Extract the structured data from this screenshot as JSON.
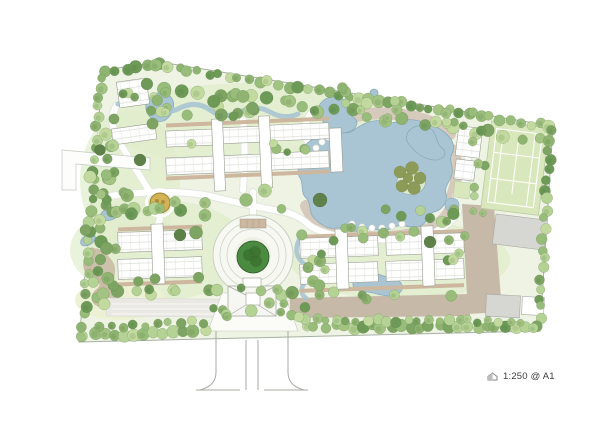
{
  "meta": {
    "scale_note": "1:250 @ A1"
  },
  "colors": {
    "paper": "#ffffff",
    "site_fill": "#eef3e3",
    "site_stroke": "#a7b0a2",
    "grass_dark": "#e0edcb",
    "grass_yellow": "#ecf1d4",
    "tan_blob": "#c9bba6",
    "water": "#a9c4d3",
    "water_stroke": "#8aabbe",
    "deck": "#d5cabb",
    "path_casing": "#e3e6dd",
    "path_white": "#ffffff",
    "road_brown": "#c6b9a8",
    "road_gray": "#e9e8e3",
    "court_green": "#d9e7bd",
    "court_line": "#ffffff",
    "building_fill": "#ffffff",
    "building_stroke": "#979c90",
    "unit_line": "#c6cabf",
    "shadow_tan": "#cdb79e",
    "gray_building": "#d6d6d2",
    "gray_building_stroke": "#a9a9a5",
    "plaza_fill": "#f7f8f2",
    "plaza_ring": "#c9cfc2",
    "center_tree": "#4b8a41",
    "center_tree_dark": "#39702f",
    "feature_gold": "#d2b254",
    "feature_ring": "#9b8336",
    "gate_stroke": "#a7aba3",
    "tree_stroke": "#5d7f49",
    "olive": "#8d9b58",
    "olive_stroke": "#6e7b3f",
    "dark_tree": "#5e8049",
    "tree_palette": [
      "#a3c383",
      "#8fb471",
      "#b4d294",
      "#7da463",
      "#c3da9f",
      "#98bd7a",
      "#6d9a57"
    ],
    "text": "#3c3c3c"
  },
  "map": {
    "boundary": [
      [
        103,
        70
      ],
      [
        160,
        62
      ],
      [
        553,
        126
      ],
      [
        540,
        331
      ],
      [
        79,
        342
      ]
    ],
    "grass": {
      "ellipses": [
        [
          250,
          125,
          140,
          42
        ],
        [
          160,
          250,
          90,
          50
        ],
        [
          400,
          260,
          110,
          40
        ],
        [
          130,
          180,
          50,
          70
        ]
      ],
      "yellow": [
        120,
        300,
        45,
        20
      ],
      "tan_blob": "M92,250 C84,262 88,272 96,278 C104,284 104,292 98,298 C94,304 100,310 110,308 C120,306 122,298 116,290 C110,282 118,274 114,264 C110,256 98,244 92,250 Z"
    },
    "decks": [
      "M322,130 Q356,110 392,114 Q430,116 450,134",
      "M306,206 Q320,236 352,236 Q390,240 420,232 Q444,226 452,206",
      "M452,150 Q462,170 452,196"
    ],
    "white_paths": [
      "M110,196 Q170,188 210,196 Q250,206 285,212 Q300,216 310,226 Q330,238 360,238 Q400,242 430,234 Q448,228 458,212",
      "M253,216 L253,192",
      "M243,190 Q246,152 243,120",
      "M310,192 Q318,160 308,142 Q300,126 312,112",
      "M150,192 Q130,160 118,140 Q108,122 116,106",
      "M456,196 Q470,180 468,160 Q466,148 478,140",
      "M160,214 Q160,228 150,236"
    ],
    "left_exit_road": [
      [
        62,
        150
      ],
      [
        150,
        158
      ],
      [
        150,
        170
      ],
      [
        76,
        164
      ],
      [
        76,
        190
      ],
      [
        62,
        190
      ]
    ],
    "roads": {
      "brown": [
        [
          [
            462,
            204
          ],
          [
            494,
            206
          ],
          [
            502,
            312
          ],
          [
            468,
            314
          ]
        ],
        [
          [
            290,
            298
          ],
          [
            470,
            294
          ],
          [
            470,
            316
          ],
          [
            290,
            318
          ]
        ]
      ],
      "gray": [
        [
          106,
          298
        ],
        [
          292,
          300
        ],
        [
          292,
          318
        ],
        [
          106,
          316
        ]
      ],
      "lane_lines": [
        [
          112,
          304,
          288,
          304
        ],
        [
          112,
          309,
          288,
          309
        ],
        [
          112,
          314,
          288,
          314
        ]
      ],
      "curvy_brown": "M92,252 Q82,268 95,276 Q110,282 100,292 Q90,300 104,304"
    },
    "water": {
      "lake": "M300,152 C306,142 318,134 330,132 C340,130 346,136 354,130 C362,124 374,118 386,122 C396,125 402,118 414,120 C428,122 436,126 444,132 C452,138 456,146 452,154 C448,160 454,166 452,174 C450,182 444,186 446,194 C448,202 442,210 434,212 C426,214 430,222 420,226 C410,230 402,222 392,228 C382,234 372,226 362,230 C352,234 344,226 336,228 C328,230 320,224 314,218 C308,212 312,204 306,198 C300,192 304,184 300,178 C296,172 300,166 297,160 C295,156 297,156 300,152 Z",
      "island": "M398,178 C400,170 410,166 418,170 C426,174 428,184 422,190 C416,196 404,196 400,190 C396,186 396,182 398,178 Z",
      "pools": [
        "M320,104 C326,96 338,94 344,100 C350,106 348,114 354,118 C360,122 356,130 348,132 C340,134 330,132 326,126 C322,120 316,112 320,104 Z",
        "M408,132 C414,124 426,124 432,130 C438,136 436,144 442,148 C448,152 444,160 436,160 C428,160 420,156 414,150 C408,144 404,140 408,132 Z",
        "M148,100 C152,92 164,90 170,96 C176,102 174,112 168,118 C162,124 152,122 148,114 C145,108 145,106 148,100 Z",
        "M354,280 C358,272 370,270 378,274 C386,278 394,276 400,282 C406,288 400,296 390,296 C380,296 374,292 366,292 C358,292 350,288 354,280 Z"
      ],
      "small_pools": [
        [
          362,
          100,
          5
        ],
        [
          374,
          93,
          4
        ]
      ],
      "pond_ellipses": [
        [
          110,
          214,
          10,
          6,
          -20
        ],
        [
          88,
          240,
          8,
          5,
          -30
        ]
      ],
      "streams": [
        {
          "d": "M118,104 Q140,96 152,106 Q164,116 180,108 Q196,100 210,110 Q224,120 240,112 Q256,104 270,112 Q284,120 298,114",
          "w": 5
        },
        {
          "d": "M300,238 Q292,252 302,262 Q312,272 304,284 Q298,292 306,298",
          "w": 4.5
        }
      ]
    },
    "chairs": [
      [
        316,
        148
      ],
      [
        322,
        142
      ],
      [
        328,
        137
      ],
      [
        335,
        133
      ],
      [
        352,
        224
      ],
      [
        362,
        227
      ],
      [
        372,
        228
      ],
      [
        382,
        228
      ],
      [
        392,
        226
      ],
      [
        402,
        224
      ]
    ],
    "buildings": {
      "strips": [
        [
          166,
          120,
          163,
          4,
          -2.5
        ],
        [
          166,
          173,
          163,
          4,
          -2.5
        ],
        [
          118,
          226,
          84,
          4,
          -2
        ],
        [
          118,
          281,
          84,
          4,
          -2
        ],
        [
          300,
          232,
          164,
          4,
          -2
        ],
        [
          300,
          286,
          164,
          4,
          -2
        ]
      ],
      "slabs": [
        [
          166,
          130,
          50,
          16,
          -2.5
        ],
        [
          219,
          127,
          42,
          16,
          -2.5
        ],
        [
          266,
          124,
          63,
          16,
          -2.5
        ],
        [
          166,
          157,
          50,
          17,
          -2.5
        ],
        [
          219,
          155,
          42,
          17,
          -2.5
        ],
        [
          266,
          152,
          63,
          17,
          -2.5
        ],
        [
          118,
          231,
          84,
          20,
          -2
        ],
        [
          118,
          258,
          84,
          20,
          -2
        ],
        [
          300,
          237,
          78,
          20,
          -2
        ],
        [
          300,
          263,
          78,
          20,
          -2
        ],
        [
          386,
          234,
          78,
          20,
          -2
        ],
        [
          386,
          260,
          78,
          20,
          -2
        ],
        [
          118,
          80,
          30,
          26,
          -8
        ],
        [
          112,
          126,
          44,
          16,
          -8
        ],
        [
          457,
          127,
          24,
          30,
          7
        ],
        [
          455,
          160,
          20,
          20,
          7
        ]
      ],
      "cores": [
        [
          213,
          119,
          11,
          72,
          -2.5
        ],
        [
          260,
          116,
          11,
          72,
          -2.5
        ],
        [
          330,
          128,
          12,
          44,
          -2.5
        ],
        [
          152,
          224,
          12,
          60,
          -2
        ],
        [
          336,
          229,
          12,
          60,
          -2
        ],
        [
          422,
          226,
          12,
          60,
          -2
        ]
      ],
      "green_pad": [
        454,
        182,
        16,
        16,
        7
      ],
      "club_pool": [
        452,
        205,
        7
      ]
    },
    "gray_buildings": [
      [
        494,
        217,
        52,
        30,
        7
      ],
      [
        486,
        295,
        34,
        22,
        3
      ]
    ],
    "outline_buildings": [
      [
        522,
        297,
        22,
        18,
        3
      ]
    ],
    "tennis": {
      "pad": [
        486,
        124,
        58,
        88
      ],
      "rot": 7,
      "cx": 514,
      "cy": 168,
      "court": [
        492,
        131,
        46,
        74
      ],
      "lines": [
        "M492,155 L538,155",
        "M492,181 L538,181",
        "M499,131 L499,205",
        "M531,131 L531,205",
        "M515,142 L515,194"
      ]
    },
    "plaza": {
      "cx": 253,
      "cy": 255,
      "r_outer": 40,
      "rings": [
        33,
        26
      ],
      "r_inner": 18,
      "tree_r": 16,
      "trellis": [
        240,
        219,
        26,
        9
      ]
    },
    "gatehouse": {
      "apron": [
        [
          222,
          293
        ],
        [
          284,
          293
        ],
        [
          298,
          331
        ],
        [
          208,
          331
        ]
      ],
      "roof_rect": [
        228,
        286,
        48,
        30
      ],
      "roof_lines": [
        "M228,286 L246,295",
        "M276,286 L258,295",
        "M228,316 L246,305",
        "M276,316 L258,305"
      ],
      "booth_rect": [
        246,
        293,
        14,
        12
      ],
      "canopy_rect": [
        243,
        278,
        18,
        9
      ],
      "drive_lines": [
        "M216,331 L216,372 Q216,386 200,390",
        "M288,331 L288,372 Q288,386 304,390",
        "M246,340 L246,390",
        "M258,340 L258,390",
        "M196,390 L240,390",
        "M264,390 L308,390"
      ]
    },
    "feature": {
      "cx": 160,
      "cy": 203,
      "r": 10
    },
    "trees": {
      "rows": [
        {
          "a": [
            106,
            73
          ],
          "b": [
            158,
            65
          ],
          "n": 6,
          "r": [
            4.5,
            6.5
          ],
          "j": 2
        },
        {
          "a": [
            158,
            65
          ],
          "b": [
            550,
            127
          ],
          "n": 40,
          "r": [
            4,
            6.5
          ],
          "j": 2.5
        },
        {
          "a": [
            150,
            84
          ],
          "b": [
            540,
            140
          ],
          "n": 24,
          "r": [
            4.5,
            7
          ],
          "j": 4
        },
        {
          "a": [
            550,
            131
          ],
          "b": [
            539,
            327
          ],
          "n": 21,
          "r": [
            4,
            6
          ],
          "j": 2.5
        },
        {
          "a": [
            84,
            336
          ],
          "b": [
            204,
            330
          ],
          "n": 13,
          "r": [
            4.5,
            6.5
          ],
          "j": 2.5
        },
        {
          "a": [
            306,
            326
          ],
          "b": [
            534,
            328
          ],
          "n": 25,
          "r": [
            4.5,
            6.5
          ],
          "j": 2.5
        },
        {
          "a": [
            100,
            327
          ],
          "b": [
            202,
            322
          ],
          "n": 10,
          "r": [
            3.5,
            5
          ],
          "j": 2
        },
        {
          "a": [
            306,
            320
          ],
          "b": [
            520,
            321
          ],
          "n": 22,
          "r": [
            3.5,
            5.5
          ],
          "j": 2
        },
        {
          "a": [
            82,
            336
          ],
          "b": [
            102,
            76
          ],
          "n": 26,
          "r": [
            4,
            6
          ],
          "j": 2.5
        },
        {
          "a": [
            94,
            300
          ],
          "b": [
            110,
            120
          ],
          "n": 14,
          "r": [
            4.5,
            6.5
          ],
          "j": 4
        }
      ],
      "clusters": [
        {
          "c": [
            140,
            110
          ],
          "s": [
            28,
            22
          ],
          "n": 10,
          "r": [
            4,
            6.5
          ]
        },
        {
          "c": [
            215,
            105
          ],
          "s": [
            75,
            13
          ],
          "n": 13,
          "r": [
            4.5,
            6.5
          ]
        },
        {
          "c": [
            360,
            103
          ],
          "s": [
            46,
            16
          ],
          "n": 10,
          "r": [
            4,
            6
          ]
        },
        {
          "c": [
            105,
            200
          ],
          "s": [
            20,
            55
          ],
          "n": 13,
          "r": [
            4.5,
            6.5
          ]
        },
        {
          "c": [
            165,
            205
          ],
          "s": [
            55,
            13
          ],
          "n": 10,
          "r": [
            4.5,
            7
          ]
        },
        {
          "c": [
            420,
            217
          ],
          "s": [
            38,
            11
          ],
          "n": 8,
          "r": [
            4,
            6
          ]
        },
        {
          "c": [
            290,
            293
          ],
          "s": [
            175,
            7
          ],
          "n": 16,
          "r": [
            4,
            6
          ]
        },
        {
          "c": [
            315,
            264
          ],
          "s": [
            16,
            26
          ],
          "n": 8,
          "r": [
            4,
            6
          ]
        },
        {
          "c": [
            375,
            234
          ],
          "s": [
            52,
            7
          ],
          "n": 8,
          "r": [
            4,
            5.5
          ]
        },
        {
          "c": [
            478,
            172
          ],
          "s": [
            7,
            42
          ],
          "n": 8,
          "r": [
            3.5,
            5
          ]
        },
        {
          "c": [
            464,
            118
          ],
          "s": [
            18,
            10
          ],
          "n": 6,
          "r": [
            4,
            5.5
          ]
        },
        {
          "c": [
            222,
            312
          ],
          "s": [
            15,
            7
          ],
          "n": 5,
          "r": [
            4,
            5.5
          ]
        },
        {
          "c": [
            291,
            310
          ],
          "s": [
            15,
            7
          ],
          "n": 5,
          "r": [
            4,
            5.5
          ]
        },
        {
          "c": [
            240,
            148
          ],
          "s": [
            68,
            5
          ],
          "n": 6,
          "r": [
            3.5,
            5
          ]
        },
        {
          "c": [
            455,
            247
          ],
          "s": [
            10,
            14
          ],
          "n": 5,
          "r": [
            4,
            5.5
          ]
        },
        {
          "c": [
            128,
            290
          ],
          "s": [
            30,
            16
          ],
          "n": 8,
          "r": [
            4.5,
            6.5
          ]
        }
      ],
      "ring": {
        "cx": 253,
        "cy": 253,
        "r1": 50,
        "r2": 64,
        "n": 12
      },
      "island": [
        [
          400,
          172,
          6
        ],
        [
          412,
          168,
          6.5
        ],
        [
          420,
          178,
          6
        ],
        [
          414,
          188,
          6.5
        ],
        [
          402,
          186,
          6
        ],
        [
          408,
          178,
          5
        ]
      ],
      "dark": [
        [
          320,
          200,
          7
        ],
        [
          180,
          235,
          6
        ],
        [
          430,
          242,
          6
        ],
        [
          140,
          160,
          6
        ],
        [
          100,
          150,
          5.5
        ]
      ]
    }
  }
}
